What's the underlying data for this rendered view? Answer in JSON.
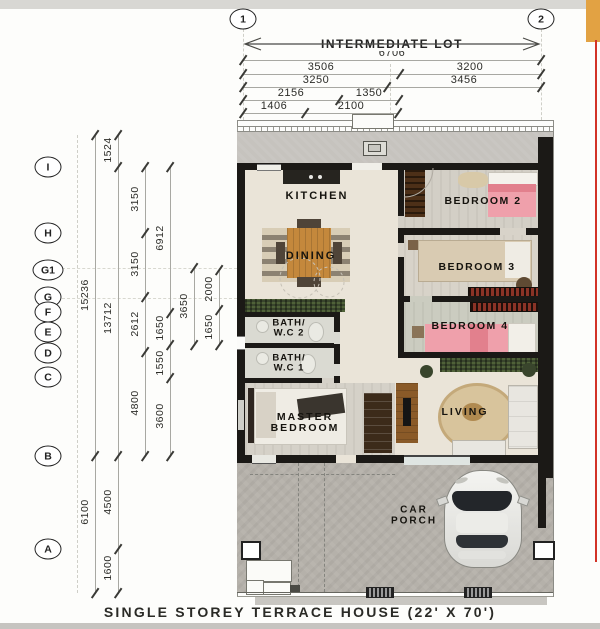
{
  "title": "SINGLE STOREY TERRACE HOUSE (22' X 70')",
  "lot": {
    "label": "INTERMEDIATE LOT"
  },
  "grid_columns": [
    "1",
    "2"
  ],
  "grid_rows": [
    "I",
    "H",
    "G1",
    "G",
    "F",
    "E",
    "D",
    "C",
    "B",
    "A"
  ],
  "top_dimensions": {
    "row1": [
      "6706"
    ],
    "row2": [
      "3506",
      "3200"
    ],
    "row3": [
      "3250",
      "3456"
    ],
    "row4": [
      "2156",
      "1350"
    ],
    "row5": [
      "1406",
      "2100"
    ]
  },
  "left_dimensions": {
    "overall": [
      "15236",
      "6100"
    ],
    "col2": [
      "1524",
      "13712",
      "4500",
      "1600"
    ],
    "col3": [
      "3150",
      "3150",
      "2612",
      "4800"
    ],
    "col4": [
      "6912",
      "1650",
      "1550",
      "3600"
    ],
    "col5": [
      "3650"
    ],
    "col6": [
      "2000",
      "1650"
    ]
  },
  "rooms": {
    "kitchen": "KITCHEN",
    "dining": "DINING",
    "bedroom2": "BEDROOM 2",
    "bedroom3": "BEDROOM 3",
    "bedroom4": "BEDROOM 4",
    "bath2": [
      "BATH/",
      "W.C 2"
    ],
    "bath1": [
      "BATH/",
      "W.C 1"
    ],
    "master": [
      "MASTER",
      "BEDROOM"
    ],
    "living": "LIVING",
    "car_porch": [
      "CAR",
      "PORCH"
    ]
  },
  "colors": {
    "wall": "#1b1916",
    "floor": "#eae4d8",
    "floor-grey": "#d3cfc6",
    "concrete": "#b5b1aa",
    "lane": "#c6c3be",
    "bed-pink": "#efa0ab",
    "bed-pink-dark": "#e2808d",
    "wood": "#c4883c",
    "dark-wood": "#3c2b1a",
    "plant-green": "#39452c",
    "rug-beige": "#d8c49c",
    "edge-red": "#d23327",
    "edge-orange": "#e2a243"
  }
}
